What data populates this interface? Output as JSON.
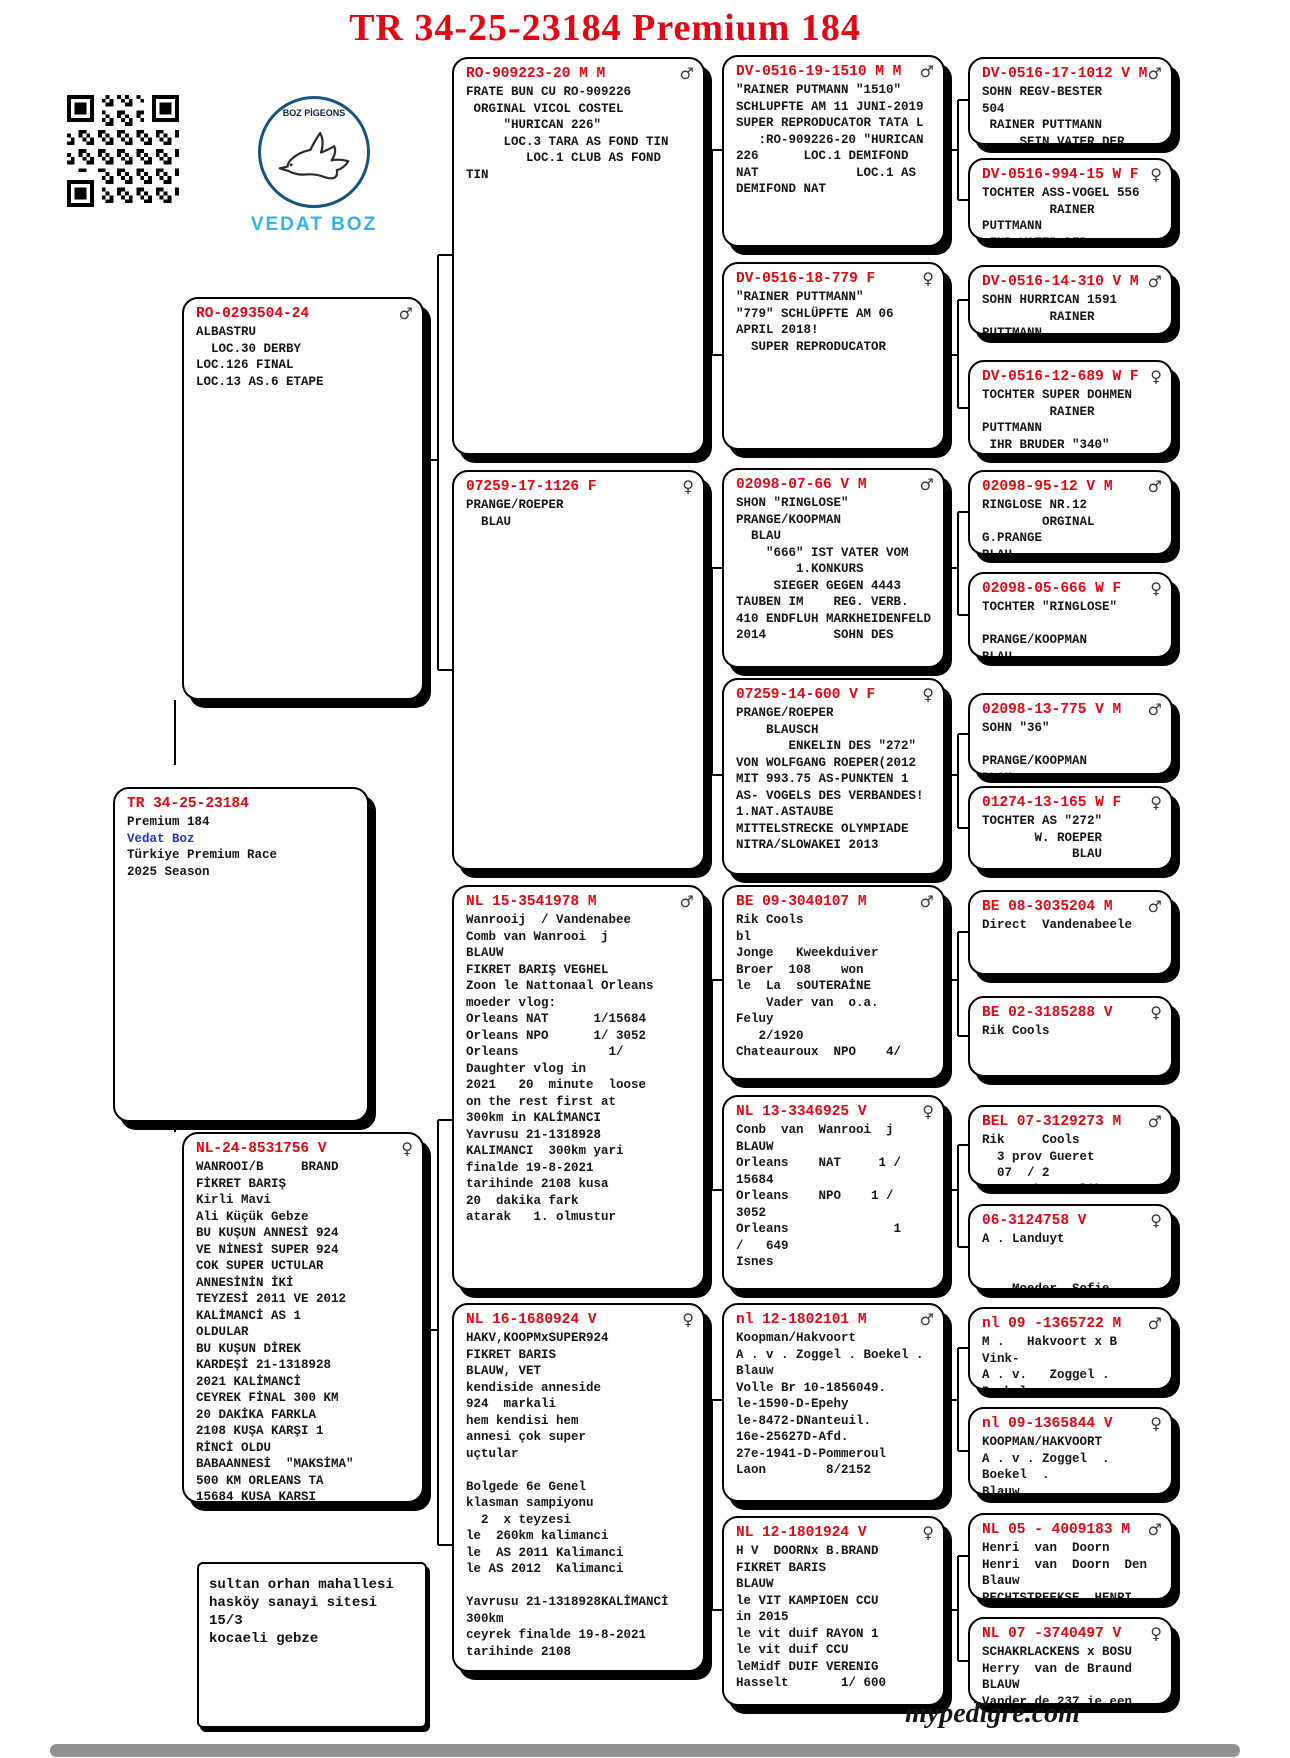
{
  "title": "TR 34-25-23184 Premium 184",
  "logo": {
    "brand_top": "BOZ PİGEONS",
    "brand_name": "VEDAT BOZ"
  },
  "colors": {
    "ring_red": "#e30613",
    "owner_blue": "#2038cc",
    "logo_blue": "#2fb3e6"
  },
  "subject": {
    "id": "TR 34-25-23184",
    "name": "Premium 184",
    "owner": "Vedat Boz",
    "race": "Türkiye Premium Race",
    "season": "2025 Season"
  },
  "address": {
    "text": "sultan orhan mahallesi\nhasköy sanayi sitesi 15/3\nkocaeli gebze"
  },
  "footer": {
    "site": "mypedigre.com"
  },
  "boxes": {
    "sire": {
      "id": "RO-0293504-24",
      "sex": "♂",
      "lines": [
        "ALBASTRU",
        "  LOC.30 DERBY",
        "LOC.126 FINAL",
        "LOC.13 AS.6 ETAPE"
      ]
    },
    "dam": {
      "id": "NL-24-8531756 V",
      "sex": "♀",
      "lines": [
        "WANROOI/B     BRAND",
        "FİKRET BARIŞ",
        "Kirli Mavi",
        "Ali Küçük Gebze",
        "BU KUŞUN ANNESİ 924",
        "VE NİNESİ SUPER 924",
        "COK SUPER UCTULAR",
        "ANNESİNİN İKİ",
        "TEYZESİ 2011 VE 2012",
        "KALİMANCİ AS 1",
        "OLDULAR",
        "BU KUŞUN DİREK",
        "KARDEŞİ 21-1318928",
        "2021 KALİMANCİ",
        "CEYREK FİNAL 300 KM",
        "20 DAKİKA FARKLA",
        "2108 KUŞA KARŞI 1",
        "RİNCİ OLDU",
        "BABAANNESİ  \"MAKSİMA\"",
        "500 KM ORLEANS TA",
        "15684 KUSA KARSI"
      ]
    },
    "ss": {
      "id": "RO-909223-20 M M",
      "sex": "♂",
      "lines": [
        "FRATE BUN CU RO-909226",
        " ORGINAL VICOL COSTEL",
        "     \"HURICAN 226\"",
        "     LOC.3 TARA AS FOND TIN",
        "        LOC.1 CLUB AS FOND",
        "TIN"
      ]
    },
    "sd": {
      "id": "07259-17-1126 F",
      "sex": "♀",
      "lines": [
        "PRANGE/ROEPER",
        "  BLAU"
      ]
    },
    "ds": {
      "id": "NL 15-3541978 M",
      "sex": "♂",
      "lines": [
        "Wanrooij  / Vandenabee",
        "Comb van Wanrooi  j",
        "BLAUW",
        "FIKRET BARIŞ VEGHEL",
        "Zoon le Nattonaal Orleans",
        "moeder vlog:",
        "Orleans NAT      1/15684",
        "Orleans NPO      1/ 3052",
        "Orleans            1/",
        "Daughter vlog in",
        "2021   20  minute  loose",
        "on the rest first at",
        "300km in KALİMANCI",
        "Yavrusu 21-1318928",
        "KALIMANCI  300km yari",
        "finalde 19-8-2021",
        "tarihinde 2108 kusa",
        "20  dakika fark",
        "atarak   1. olmustur"
      ]
    },
    "dd": {
      "id": "NL 16-1680924 V",
      "sex": "♀",
      "lines": [
        "HAKV,KOOPMxSUPER924",
        "FIKRET BARIS",
        "BLAUW, VET",
        "kendiside anneside",
        "924  markali",
        "hem kendisi hem",
        "annesi çok super",
        "uçtular",
        "",
        "Bolgede 6e Genel",
        "klasman sampiyonu",
        "  2  x teyzesi",
        "le  260km kalimanci",
        "le  AS 2011 Kalimanci",
        "le AS 2012  Kalimanci",
        "",
        "Yavrusu 21-1318928KALİMANCİ",
        "300km",
        "ceyrek finalde 19-8-2021",
        "tarihinde 2108"
      ]
    },
    "sss": {
      "id": "DV-0516-19-1510 M M",
      "sex": "♂",
      "lines": [
        "\"RAINER PUTMANN \"1510\"",
        "SCHLUPFTE AM 11 JUNI-2019",
        "SUPER REPRODUCATOR TATA L",
        "   :RO-909226-20 \"HURICAN",
        "226      LOC.1 DEMIFOND",
        "NAT             LOC.1 AS",
        "DEMIFOND NAT"
      ]
    },
    "ssd": {
      "id": "DV-0516-18-779 F",
      "sex": "♀",
      "lines": [
        "\"RAINER PUTTMANN\"",
        "\"779\" SCHLÜPFTE AM 06",
        "APRIL 2018!",
        "  SUPER REPRODUCATOR"
      ]
    },
    "sds": {
      "id": "02098-07-66 V M",
      "sex": "♂",
      "lines": [
        "SHON \"RINGLOSE\"",
        "PRANGE/KOOPMAN",
        "  BLAU",
        "    \"666\" IST VATER VOM",
        "        1.KONKURS",
        "     SIEGER GEGEN 4443",
        "TAUBEN IM    REG. VERB.",
        "410 ENDFLUH MARKHEIDENFELD",
        "2014         SOHN DES"
      ]
    },
    "sdd": {
      "id": "07259-14-600 V F",
      "sex": "♀",
      "lines": [
        "PRANGE/ROEPER",
        "    BLAUSCH",
        "       ENKELIN DES \"272\"",
        "VON WOLFGANG ROEPER(2012",
        "MIT 993.75 AS-PUNKTEN 1",
        "AS- VOGELS DES VERBANDES!",
        "1.NAT.ASTAUBE",
        "MITTELSTRECKE OLYMPIADE",
        "NITRA/SLOWAKEI 2013"
      ]
    },
    "dss": {
      "id": "BE 09-3040107 M",
      "sex": "♂",
      "lines": [
        "Rik Cools",
        "bl",
        "Jonge   Kweekduiver",
        "Broer  108    won",
        "le  La  sOUTERAİNE",
        "    Vader van  o.a.",
        "Feluy",
        "   2/1920",
        "Chateauroux  NPO    4/"
      ]
    },
    "dsd": {
      "id": "NL 13-3346925 V",
      "sex": "♀",
      "lines": [
        "Conb  van  Wanrooi  j",
        "BLAUW",
        "Orleans    NAT     1 /",
        "15684",
        "Orleans    NPO    1 /",
        "3052",
        "Orleans              1",
        "/   649",
        "Isnes"
      ]
    },
    "dds": {
      "id": "nl 12-1802101 M",
      "sex": "♂",
      "lines": [
        "Koopman/Hakvoort",
        "A . v . Zoggel . Boekel .",
        "Blauw",
        "Volle Br 10-1856049.",
        "le-1590-D-Epehy",
        "le-8472-DNanteuil.",
        "16e-25627D-Afd.",
        "27e-1941-D-Pommeroul",
        "Laon        8/2152"
      ]
    },
    "ddd": {
      "id": "NL 12-1801924 V",
      "sex": "♀",
      "lines": [
        "H V  DOORNx B.BRAND",
        "FIKRET BARIS",
        "BLAUW",
        "le VIT KAMPIOEN CCU",
        "in 2015",
        "le vit duif RAYON 1",
        "le vit duif CCU",
        "leMidf DUIF VERENIG",
        "Hasselt       1/ 600"
      ]
    },
    "ssss": {
      "id": "DV-0516-17-1012 V M",
      "sex": "♂",
      "lines": [
        "SOHN REGV-BESTER",
        "504",
        " RAINER PUTTMANN",
        "     SEIN VATER DER"
      ]
    },
    "sssd": {
      "id": "DV-0516-994-15 W F",
      "sex": "♀",
      "lines": [
        "TOCHTER ASS-VOGEL 556",
        "         RAINER",
        "PUTTMANN",
        " IHR VATER DER"
      ]
    },
    "ssds": {
      "id": "DV-0516-14-310 V M",
      "sex": "♂",
      "lines": [
        "SOHN HURRICAN 1591",
        "         RAINER",
        "PUTTMANN",
        " ERL ST EIH"
      ]
    },
    "ssdd": {
      "id": "DV-0516-12-689 W F",
      "sex": "♀",
      "lines": [
        "TOCHTER SUPER DOHMEN",
        "         RAINER",
        "PUTTMANN",
        " IHR BRUDER \"340\""
      ]
    },
    "sdss": {
      "id": "02098-95-12 V M",
      "sex": "♂",
      "lines": [
        "RINGLOSE NR.12",
        "        ORGINAL",
        "G.PRANGE",
        "BLAU"
      ]
    },
    "sdsd": {
      "id": "02098-05-666 W F",
      "sex": "♀",
      "lines": [
        "TOCHTER \"RINGLOSE\"",
        "",
        "PRANGE/KOOPMAN",
        "BLAU"
      ]
    },
    "sdds": {
      "id": "02098-13-775 V M",
      "sex": "♂",
      "lines": [
        "SOHN \"36\"",
        "",
        "PRANGE/KOOPMAN",
        "BLAU"
      ]
    },
    "sddd": {
      "id": "01274-13-165 W F",
      "sex": "♀",
      "lines": [
        "TOCHTER AS \"272\"",
        "       W. ROEPER",
        "            BLAU"
      ]
    },
    "dsss": {
      "id": "BE 08-3035204 M",
      "sex": "♂",
      "lines": [
        "Direct  Vandenabeele"
      ]
    },
    "dssd": {
      "id": "BE 02-3185288 V",
      "sex": "♀",
      "lines": [
        "Rik Cools"
      ]
    },
    "dsds": {
      "id": "BEL 07-3129273 M",
      "sex": "♂",
      "lines": [
        "Rik     Cools",
        "  3 prov Gueret",
        "  07  / 2",
        "Ze   Schone Blikoen"
      ]
    },
    "dsdd": {
      "id": "06-3124758 V",
      "sex": "♀",
      "lines": [
        "A . Landuyt",
        "",
        "",
        "    Moeder  Sofie"
      ]
    },
    "ddss": {
      "id": "nl 09 -1365722 M",
      "sex": "♂",
      "lines": [
        "M .   Hakvoort x B",
        "Vink-",
        "A . v.   Zoggel .",
        "Boekel"
      ]
    },
    "ddsd": {
      "id": "nl 09-1365844 V",
      "sex": "♀",
      "lines": [
        "KOOPMAN/HAKVOORT",
        "A . v . Zoggel  .",
        "Boekel  .",
        "Blauw"
      ]
    },
    "ddds": {
      "id": "NL 05 - 4009183 M",
      "sex": "♂",
      "lines": [
        "Henri  van  Doorn",
        "Henri  van  Doorn  Den",
        "Blauw",
        "RECHTSTREEKSE  HENRI"
      ]
    },
    "dddd": {
      "id": "NL 07 -3740497 V",
      "sex": "♀",
      "lines": [
        "SCHAKRLACKENS x BOSU",
        "Herry  van de Braund",
        "BLAUW",
        "Vander de 237 ie een"
      ]
    }
  }
}
